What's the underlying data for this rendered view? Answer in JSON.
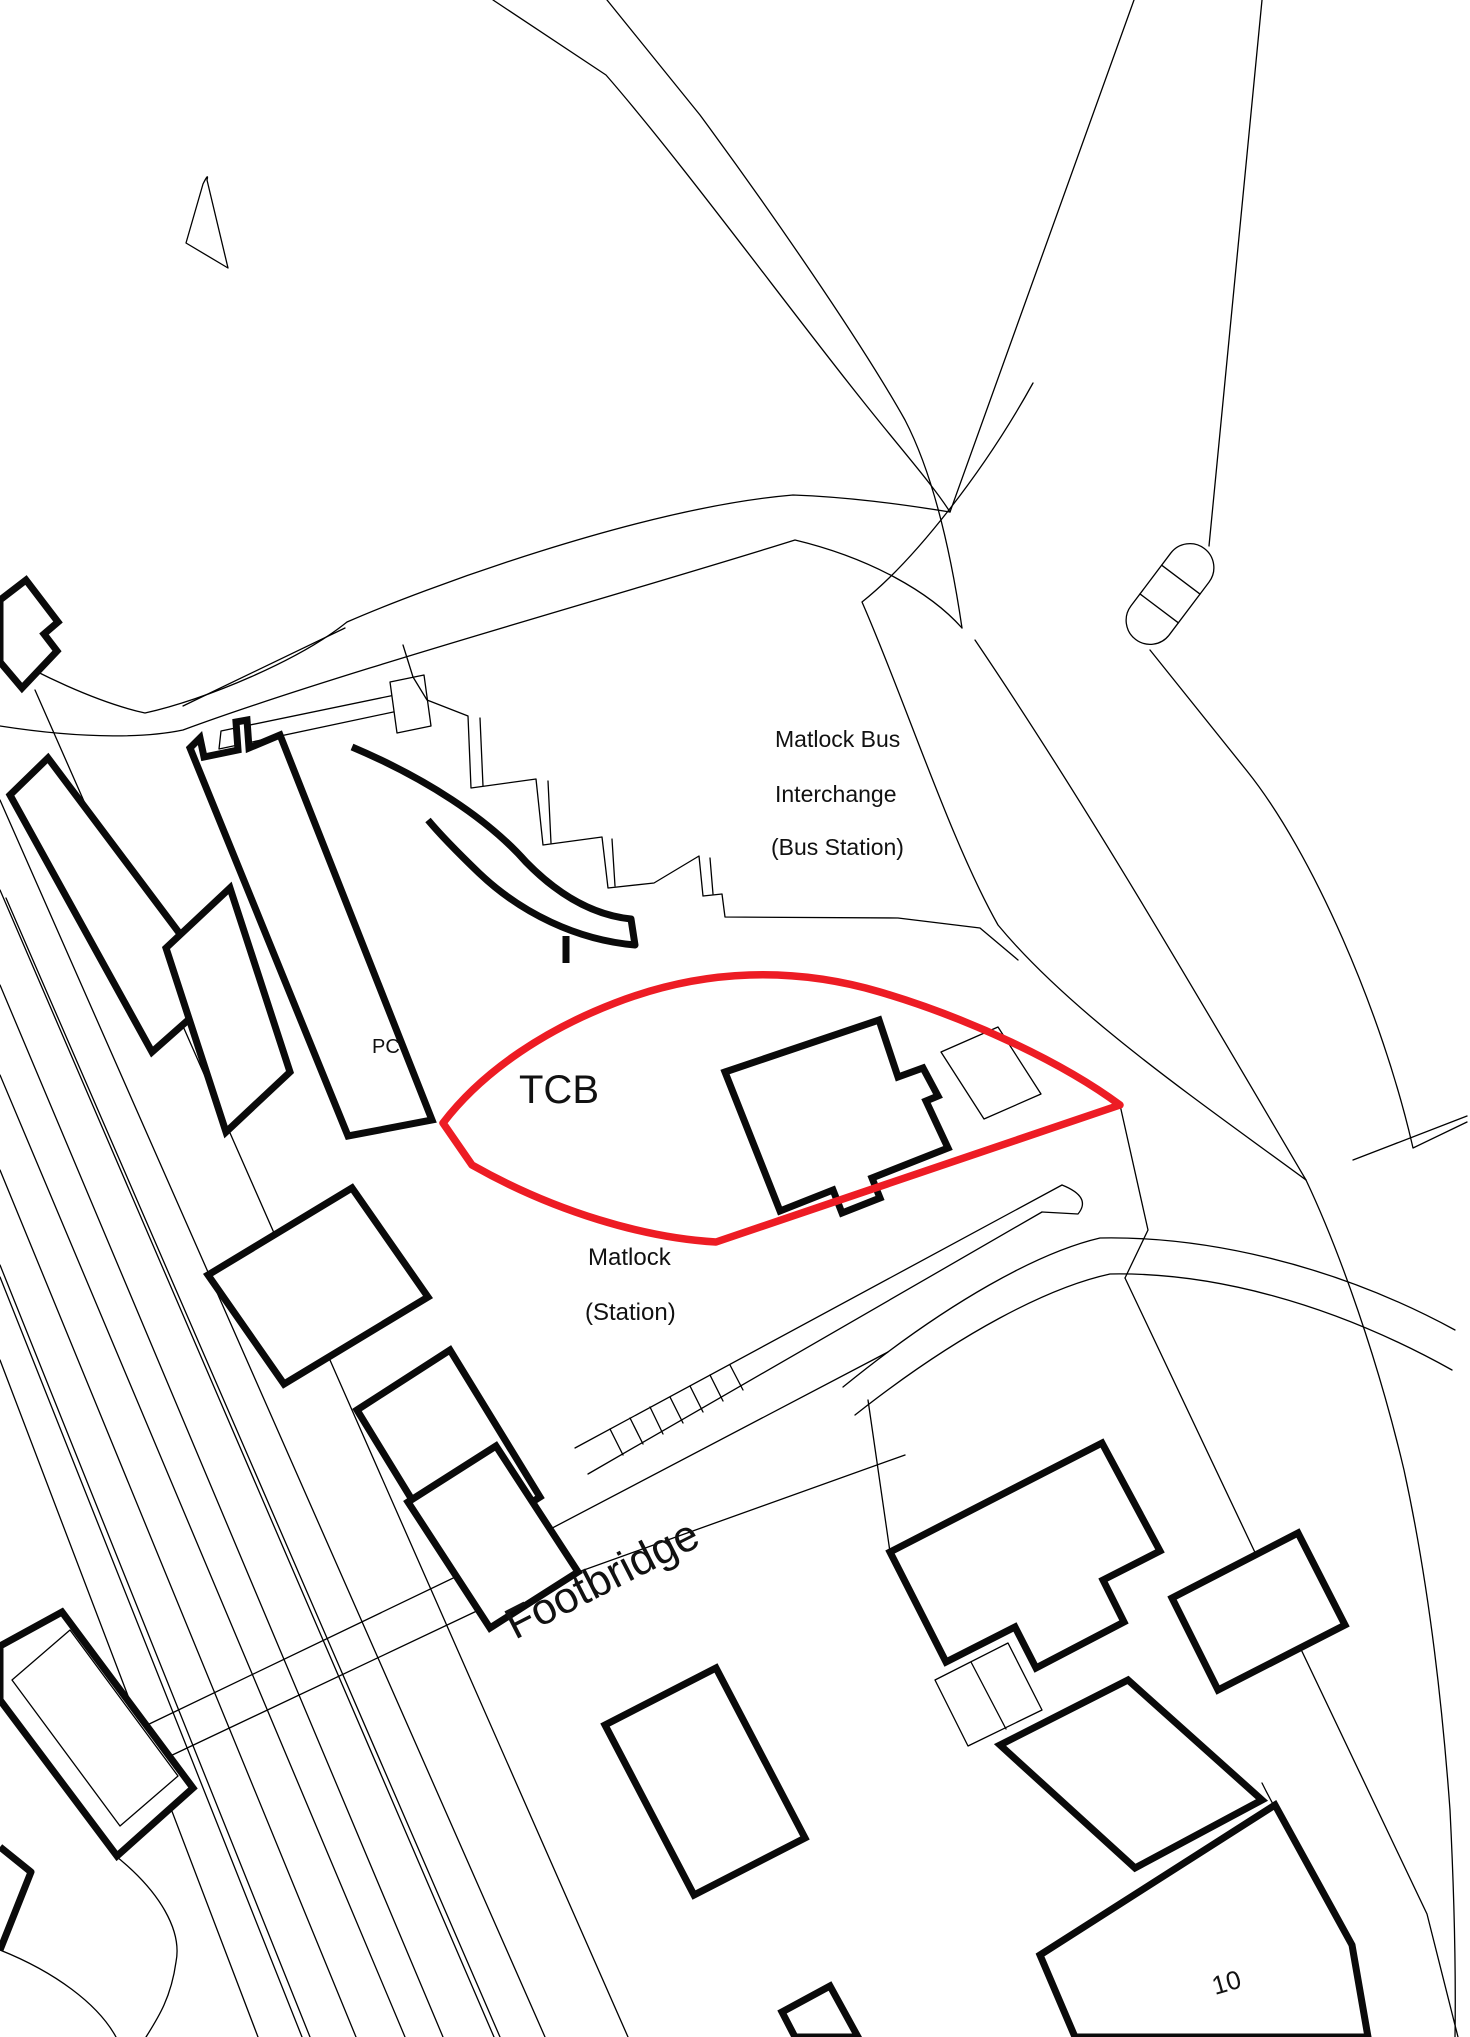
{
  "map": {
    "background_color": "#ffffff",
    "line_color": "#000000",
    "boundary_color": "#ed1c24",
    "labels": {
      "interchange": [
        "Matlock Bus",
        "Interchange",
        "(Bus Station)"
      ],
      "tcb": "TCB",
      "pc": "PC",
      "station": [
        "Matlock",
        "(Station)"
      ],
      "footbridge": "Footbridge",
      "house_number": "10"
    }
  }
}
